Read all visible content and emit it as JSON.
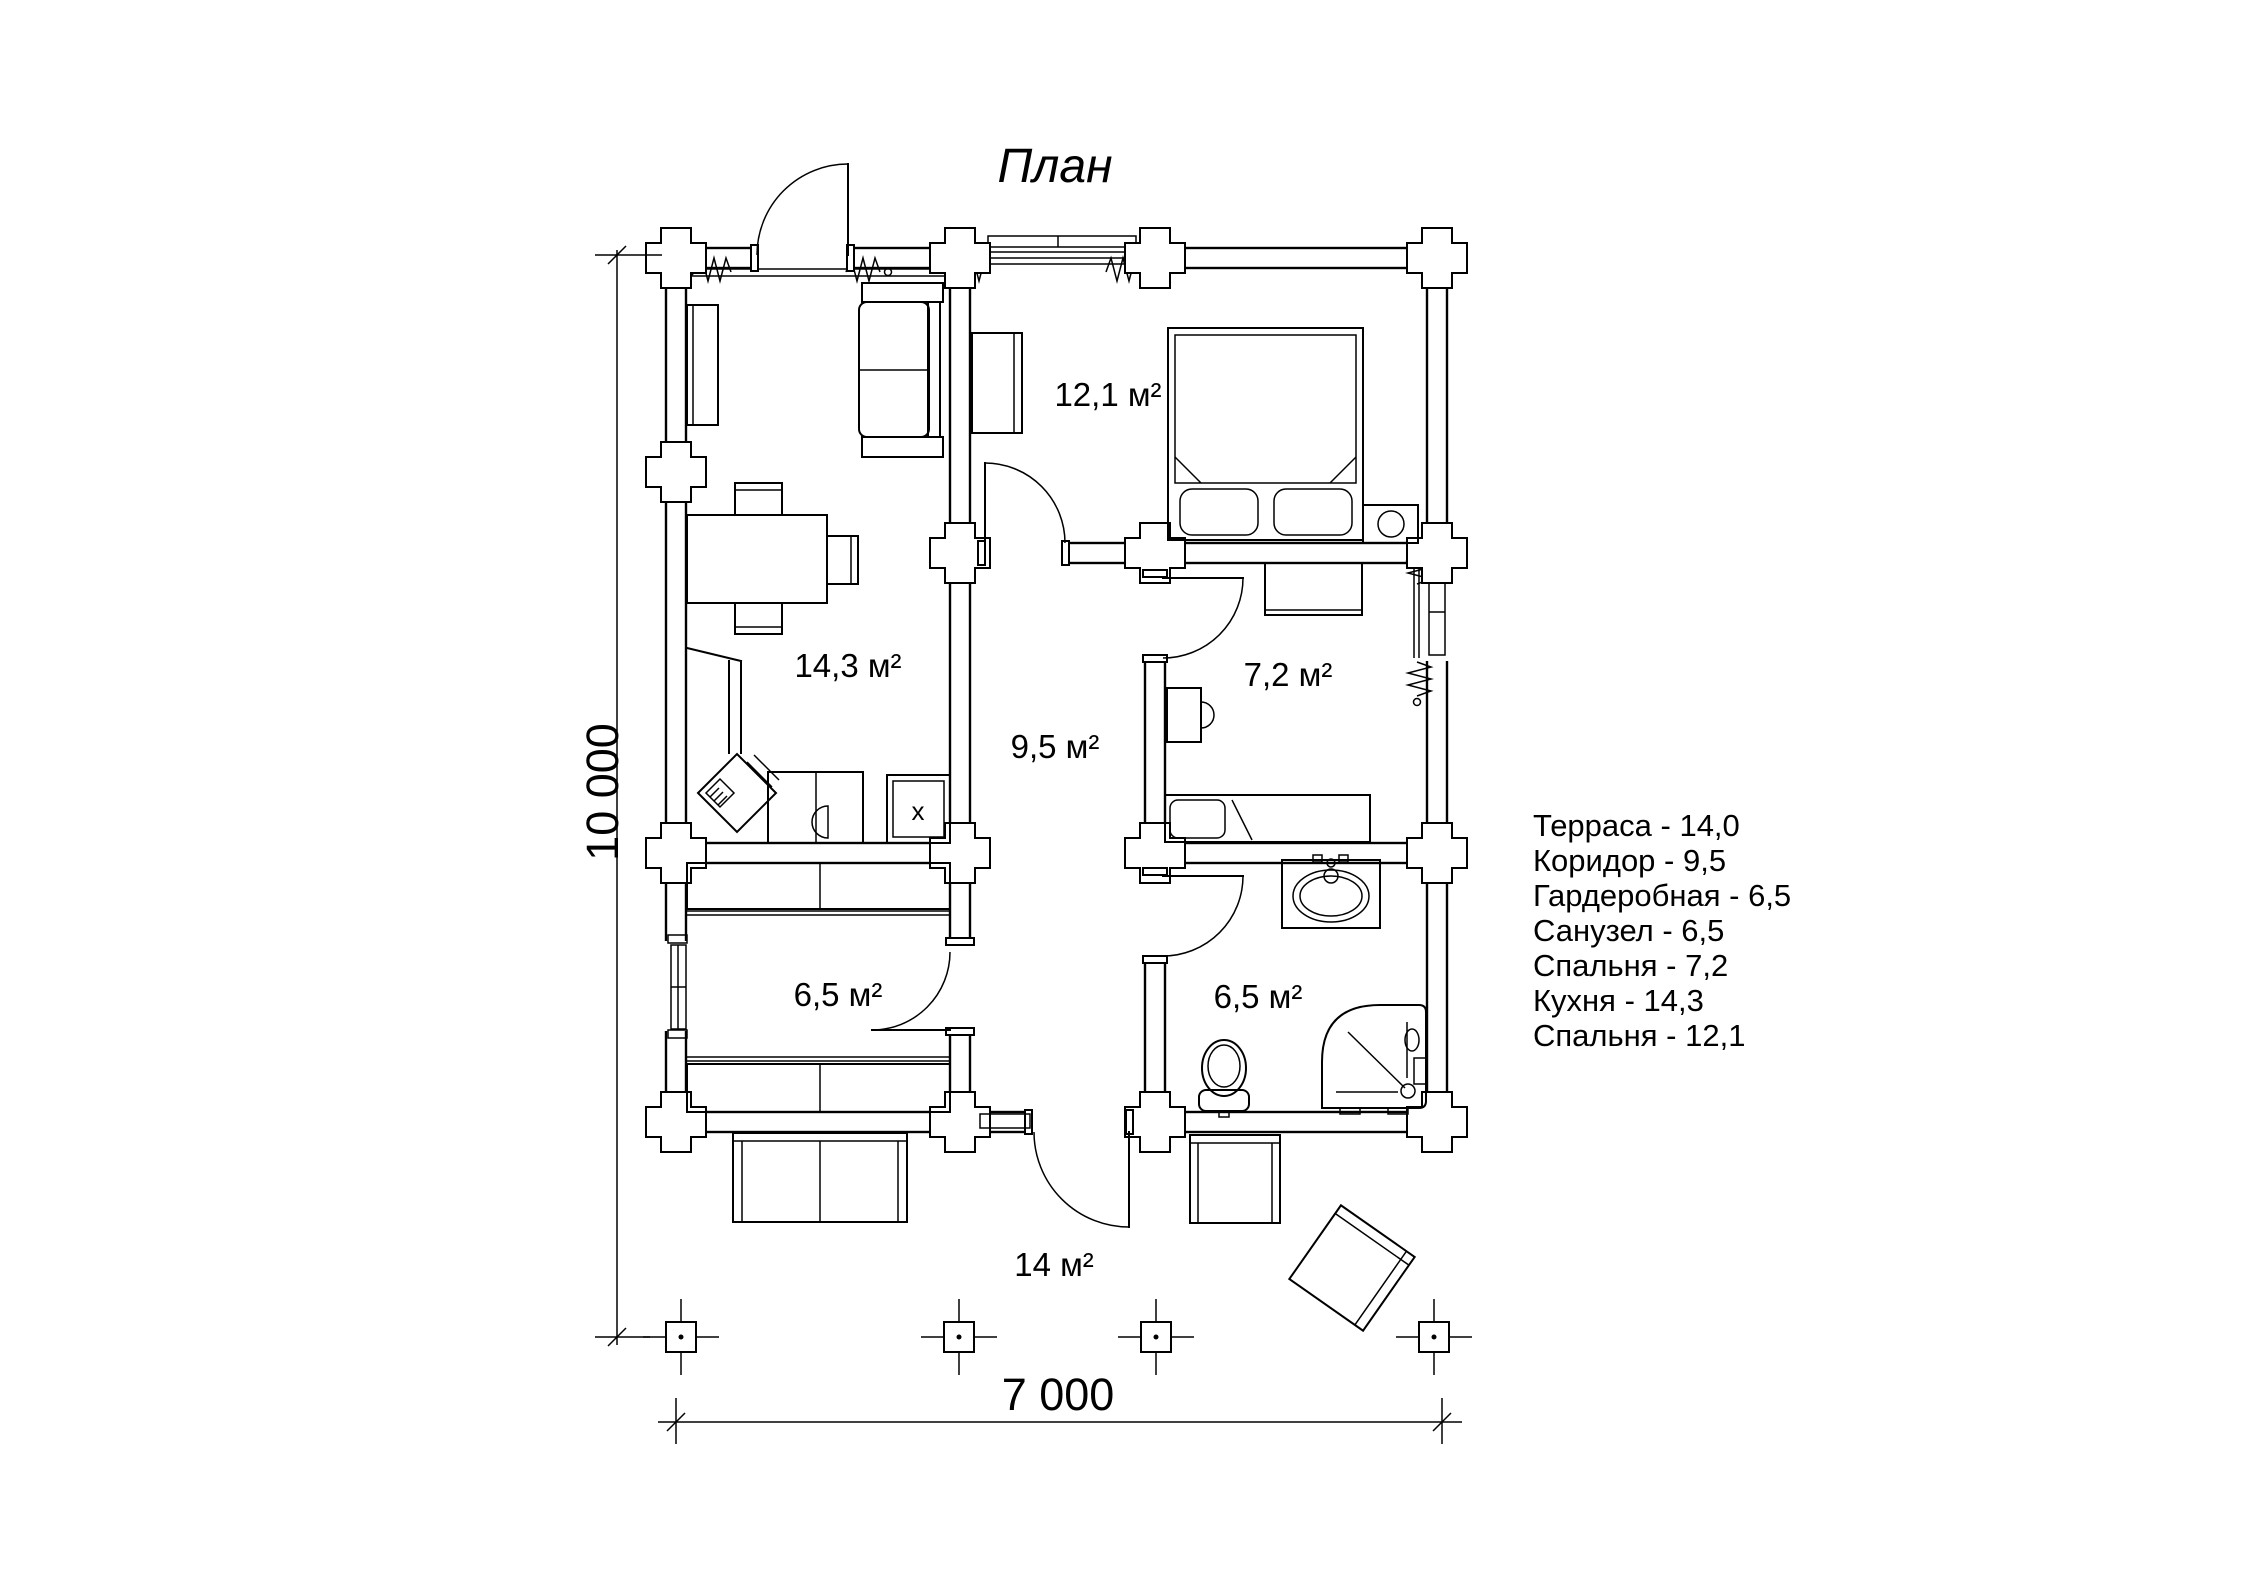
{
  "title": "План",
  "plan": {
    "room_labels": {
      "bedroom_top": "12,1 м²",
      "kitchen": "14,3 м²",
      "bedroom_right": "7,2 м²",
      "corridor": "9,5 м²",
      "wardrobe": "6,5 м²",
      "bathroom": "6,5 м²",
      "terrace": "14 м²"
    },
    "stove_mark": "х"
  },
  "dimensions": {
    "vertical": "10 000",
    "horizontal": "7 000"
  },
  "legend": {
    "items": [
      "Терраса - 14,0",
      "Коридор - 9,5",
      "Гардеробная  - 6,5",
      "Санузел - 6,5",
      "Спальня - 7,2",
      "Кухня - 14,3",
      "Спальня - 12,1"
    ]
  },
  "colors": {
    "line": "#000000",
    "background": "#ffffff"
  }
}
